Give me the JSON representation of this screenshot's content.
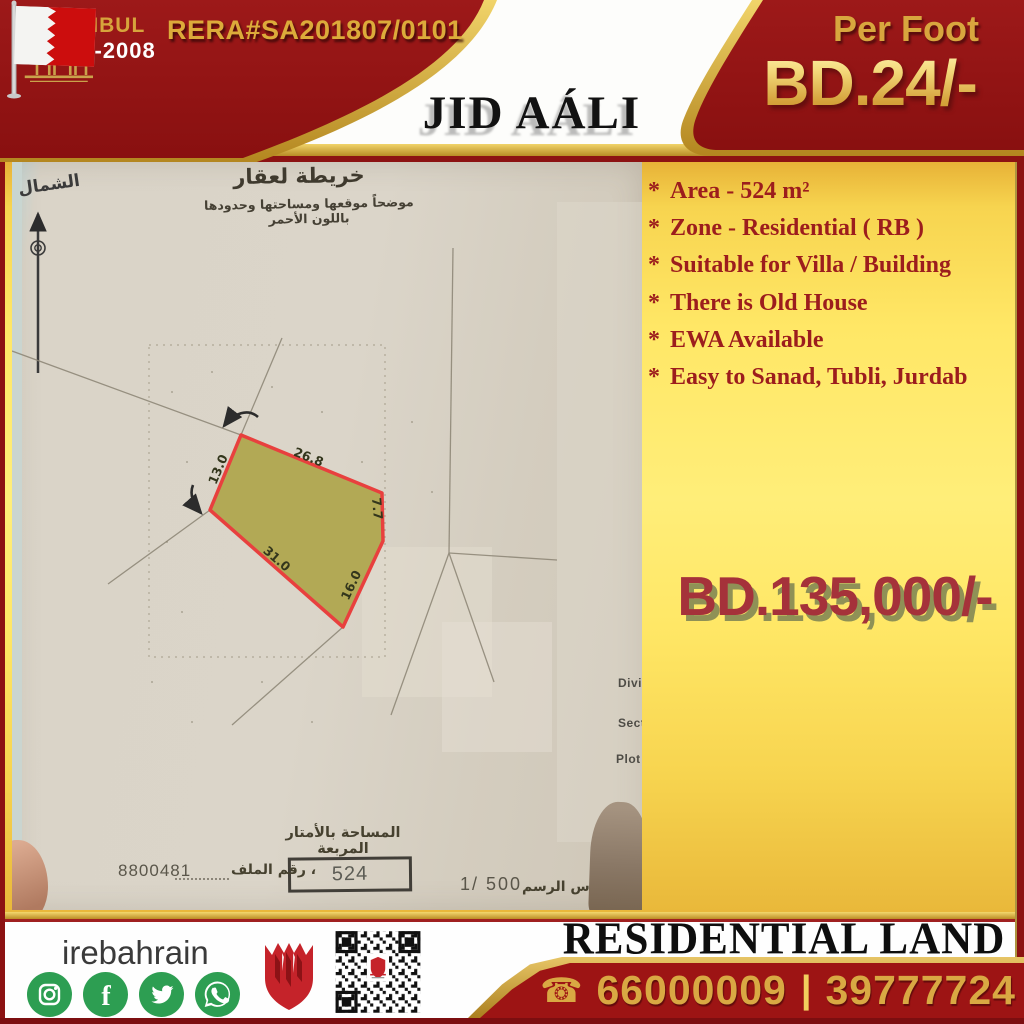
{
  "header": {
    "rera": "RERA#SA201807/0101",
    "brand_name": "ISTANBUL",
    "brand_since": "SINCE-2008",
    "location": "JID AÁLI",
    "per_foot_label": "Per Foot",
    "per_foot_price": "BD.24/-"
  },
  "features": {
    "bullet": "*",
    "items": [
      "Area - 524 m²",
      "Zone - Residential ( RB )",
      "Suitable for Villa / Building",
      "There is Old House",
      "EWA Available",
      "Easy to Sanad, Tubli, Jurdab"
    ]
  },
  "price": {
    "amount": "BD.135,000/-"
  },
  "map": {
    "title_ar": "خريطة لعقار",
    "subtitle_ar": "موضحاً موقعها ومساحتها وحدودها باللون الأحمر",
    "north_label_ar": "الشمال",
    "edge_labels": {
      "top_left": "13.0",
      "top": "26.8",
      "right": "7.7",
      "bottom_right": "16.0",
      "bottom_left": "31.0"
    },
    "area_label_ar": "المساحة بالأمتار المربعة",
    "area_value": "524",
    "file_value": "8800481",
    "file_label_ar": "رقم الملف ،",
    "scale_value": "1/ 500",
    "scale_label_ar": "مقياس الرسم ،",
    "partial_labels": [
      "Divis",
      "Sect",
      "Plot"
    ]
  },
  "footer": {
    "handle": "irebahrain",
    "banner": "RESIDENTIAL LAND",
    "phone_icon": "☎",
    "phones": [
      "66000009",
      "39777724"
    ],
    "phone_separator": "|"
  },
  "icons": {
    "social": [
      "instagram-icon",
      "facebook-icon",
      "twitter-icon",
      "whatsapp-icon"
    ],
    "brand_logo": "building-logo-icon",
    "flag": "bahrain-flag-icon",
    "north": "north-arrow-icon",
    "qr": "qr-code"
  },
  "colors": {
    "dark_red": "#951616",
    "gold": "#d9a843",
    "yellow_panel": "#ffe766",
    "plot_fill": "#b2a955",
    "plot_stroke": "#e8403e",
    "feature_text": "#9c1d1d"
  }
}
